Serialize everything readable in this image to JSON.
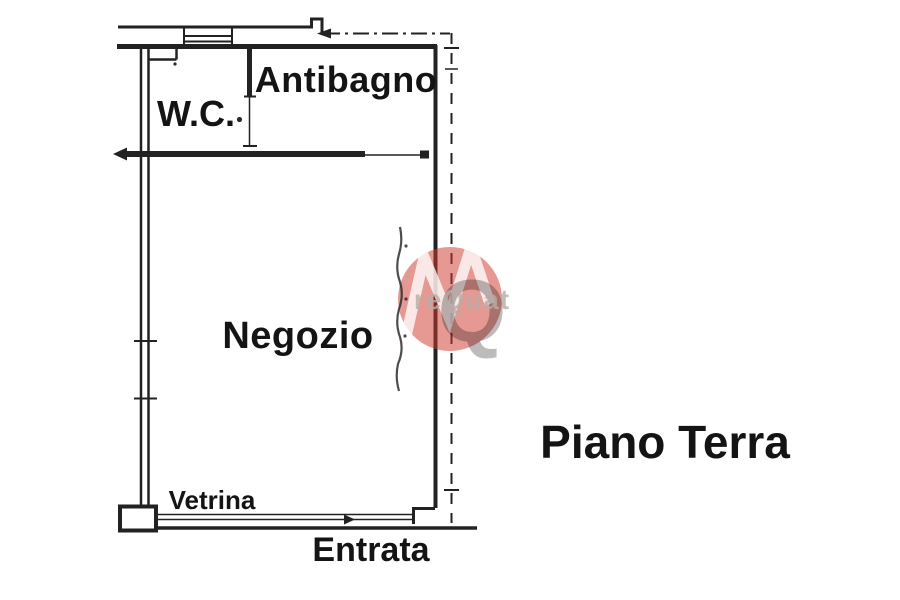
{
  "page": {
    "kind": "scanned floor plan",
    "background_color": "#ffffff",
    "ink_color": "#222222"
  },
  "floor_plan": {
    "floor_title": "Piano Terra",
    "rooms": [
      {
        "id": "wc",
        "label": "W.C."
      },
      {
        "id": "antibagno",
        "label": "Antibagno"
      },
      {
        "id": "negozio",
        "label": "Negozio"
      }
    ],
    "annotations": [
      {
        "id": "vetrina",
        "label": "Vetrina"
      },
      {
        "id": "entrata",
        "label": "Entrata"
      }
    ]
  },
  "watermark": {
    "monogram_m": "M",
    "monogram_q": "Q",
    "visible_text": "reQuat",
    "circle_color": "#d0392e",
    "monogram_m_color": "#ffffff",
    "monogram_q_color": "#8f8f8f",
    "text_color": "#b9aca6"
  }
}
